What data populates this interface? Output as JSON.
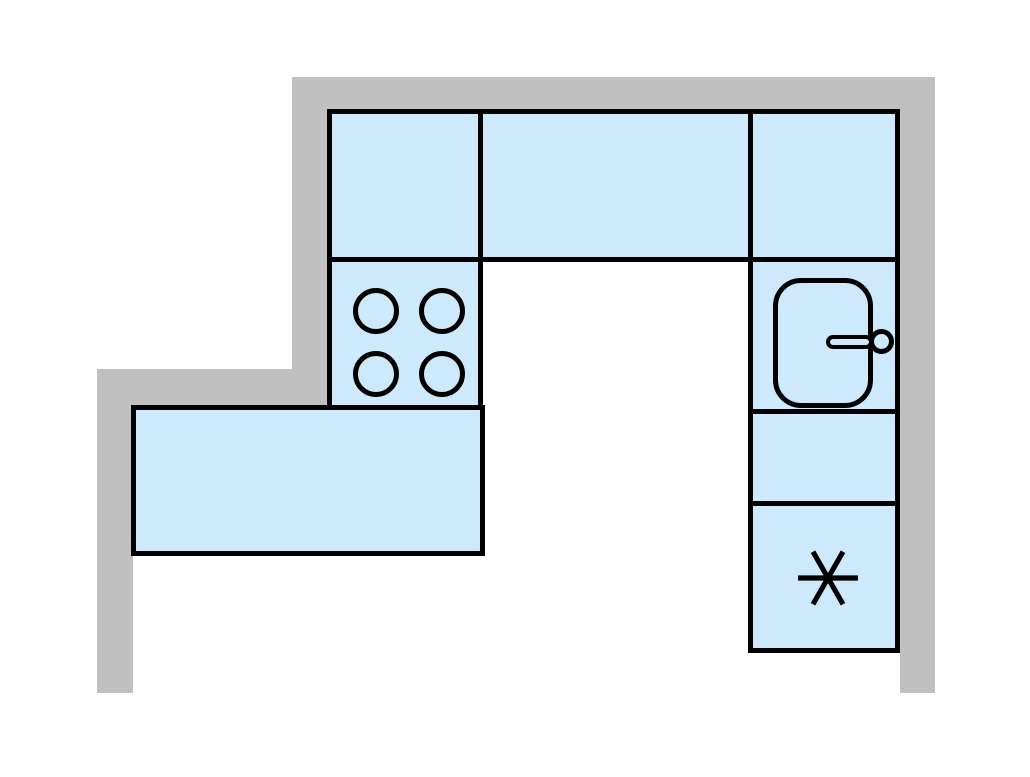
{
  "title": "Kitchen floor plan",
  "colors": {
    "background": "#ffffff",
    "wall": "#c0c0c0",
    "cabinet_fill": "#cde9fb",
    "outline": "#000000"
  },
  "plan": {
    "room_shape": "stepped-l-shape",
    "walls": [
      {
        "id": "wall-top",
        "side": "top"
      },
      {
        "id": "wall-right",
        "side": "right"
      },
      {
        "id": "wall-left-upper",
        "side": "left-upper"
      },
      {
        "id": "wall-step",
        "side": "left-step"
      },
      {
        "id": "wall-left-lower",
        "side": "left-lower"
      }
    ],
    "cabinets": [
      {
        "id": "top-left-cabinet",
        "type": "base-cabinet"
      },
      {
        "id": "top-middle-cabinet",
        "type": "base-cabinet"
      },
      {
        "id": "top-right-cabinet",
        "type": "base-cabinet"
      },
      {
        "id": "cooktop-cabinet",
        "type": "cooktop",
        "burner_count": 4
      },
      {
        "id": "sink-cabinet",
        "type": "sink",
        "fixture": "single-basin-sink-with-faucet"
      },
      {
        "id": "right-middle-cabinet",
        "type": "base-cabinet"
      },
      {
        "id": "freezer-cabinet",
        "type": "refrigerator-freezer",
        "icon": "snowflake-icon"
      },
      {
        "id": "left-counter",
        "type": "counter"
      }
    ]
  }
}
